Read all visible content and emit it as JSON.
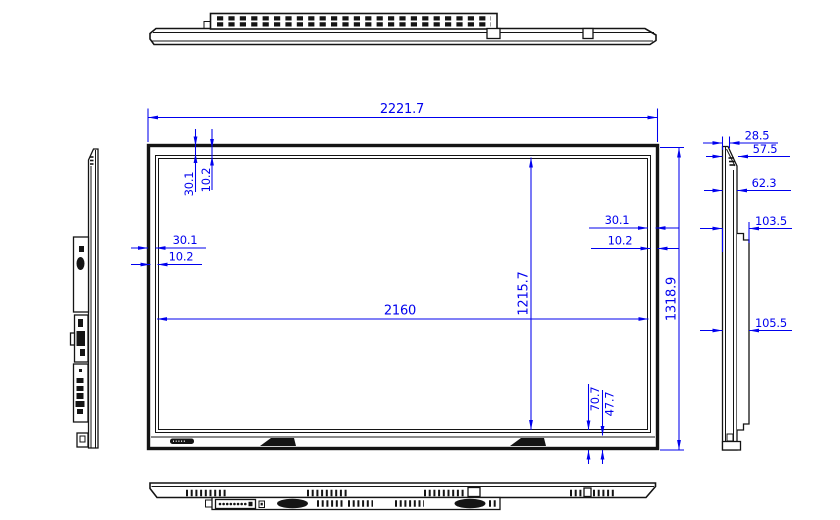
{
  "drawing": {
    "kind": "display-panel-technical-drawing",
    "colors": {
      "dimension_blue": "#0000ee",
      "line_black": "#141414",
      "background": "#ffffff"
    },
    "dims": {
      "overall_width": "2221.7",
      "active_width": "2160",
      "overall_height": "1318.9",
      "active_height": "1215.7",
      "top_bezel": "30.1",
      "top_glass": "10.2",
      "left_bezel": "30.1",
      "left_glass": "10.2",
      "right_bezel": "30.1",
      "right_glass": "10.2",
      "bottom_bezel": "70.7",
      "bottom_glass": "47.7",
      "depth_front": "28.5",
      "depth_top": "57.5",
      "depth_body": "62.3",
      "depth_back_upper": "103.5",
      "depth_back_lower": "105.5"
    }
  }
}
